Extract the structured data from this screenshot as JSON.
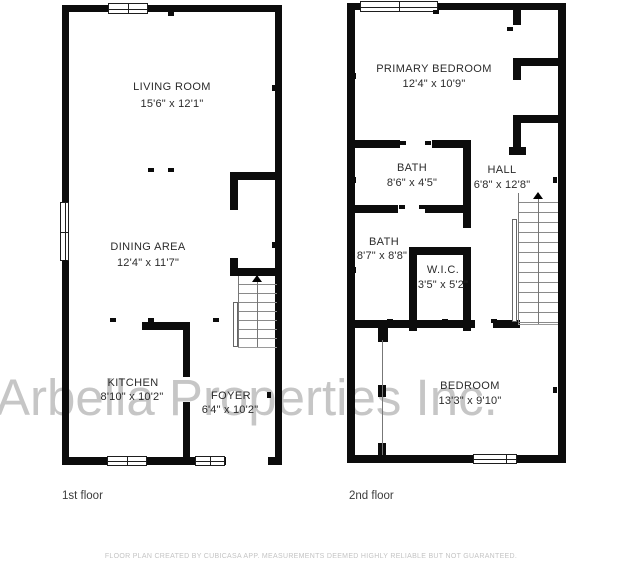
{
  "watermark": "Arbella Properties Inc.",
  "floors": [
    {
      "caption": "1st floor",
      "rooms": [
        {
          "name": "LIVING ROOM",
          "dims": "15'6\" x 12'1\""
        },
        {
          "name": "DINING AREA",
          "dims": "12'4\" x 11'7\""
        },
        {
          "name": "KITCHEN",
          "dims": "8'10\" x 10'2\""
        },
        {
          "name": "FOYER",
          "dims": "6'4\" x 10'2\""
        }
      ]
    },
    {
      "caption": "2nd floor",
      "rooms": [
        {
          "name": "PRIMARY BEDROOM",
          "dims": "12'4\" x 10'9\""
        },
        {
          "name": "BATH",
          "dims": "8'6\" x 4'5\""
        },
        {
          "name": "HALL",
          "dims": "6'8\" x 12'8\""
        },
        {
          "name": "BATH",
          "dims": "8'7\" x 8'8\""
        },
        {
          "name": "W.I.C.",
          "dims": "3'5\" x 5'2\""
        },
        {
          "name": "BEDROOM",
          "dims": "13'3\" x 9'10\""
        }
      ]
    }
  ],
  "footer": {
    "disclaimer": "FLOOR PLAN CREATED BY CUBICASA APP. MEASUREMENTS DEEMED HIGHLY RELIABLE BUT NOT GUARANTEED."
  },
  "colors": {
    "wall": "#0c0c0c",
    "watermark": "#c0c0c0",
    "label": "#2b2b2b"
  }
}
